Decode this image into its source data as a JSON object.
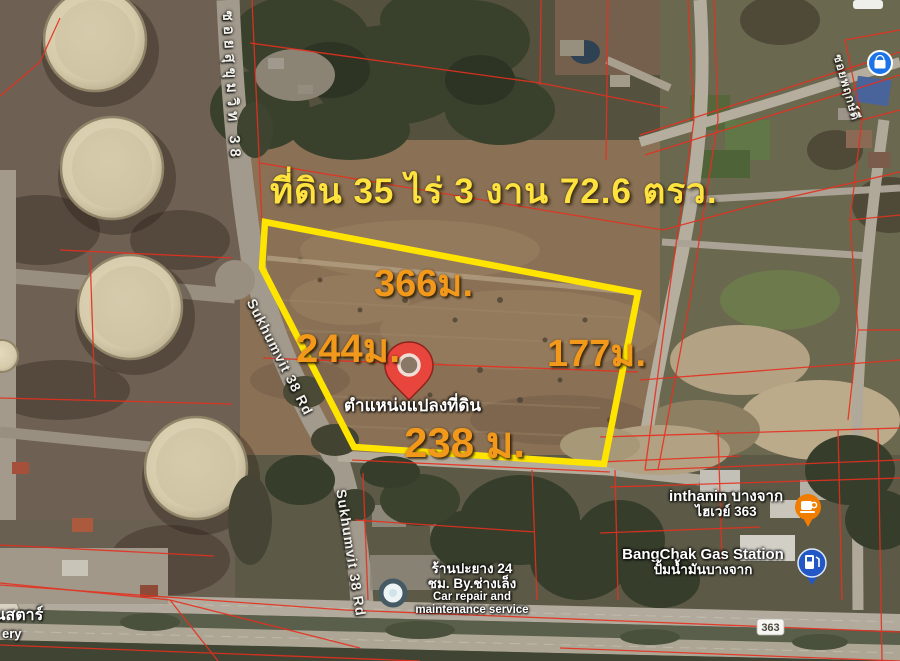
{
  "title": {
    "text": "ที่ดิน 35 ไร่ 3 งาน 72.6 ตรว."
  },
  "dimensions": {
    "top": "366ม.",
    "left": "244ม.",
    "right": "177ม.",
    "bottom": "238 ม."
  },
  "pin": {
    "label": "ตำแหน่งแปลงที่ดิน"
  },
  "roads": {
    "soi_upper": "ซอยสุขุมวิท 38",
    "sukhumvit_mid": "Sukhumvit 38 Rd",
    "sukhumvit_lower": "Sukhumvit 38 Rd",
    "soi_right": "ซอยพฤกษ์ดี"
  },
  "route_shield": {
    "number": "363"
  },
  "pois": {
    "inthanin": {
      "line1": "inthanin บางจาก",
      "line2": "ไฮเวย์ 363"
    },
    "bangchak": {
      "line1": "BangChak Gas Station",
      "line2": "ปั้มน้ำมันบางจาก"
    },
    "car_repair": {
      "line1": "ร้านปะยาง 24",
      "line2": "ชม. By.ช่างเล็ง",
      "line3": "Car repair and",
      "line4": "maintenance service"
    }
  },
  "corner": {
    "thai": "มันสตาร์",
    "en": "ery"
  },
  "colors": {
    "parcel_outline": "#ffe400",
    "cadastral_line": "#e5301f",
    "dimension_label": "#f2991b",
    "title_label": "#ffe23e",
    "pin": "#e8453c",
    "inthanin_marker": "#f07d00",
    "bangchak_marker": "#2257c5",
    "shop_marker": "#1a73e8"
  }
}
